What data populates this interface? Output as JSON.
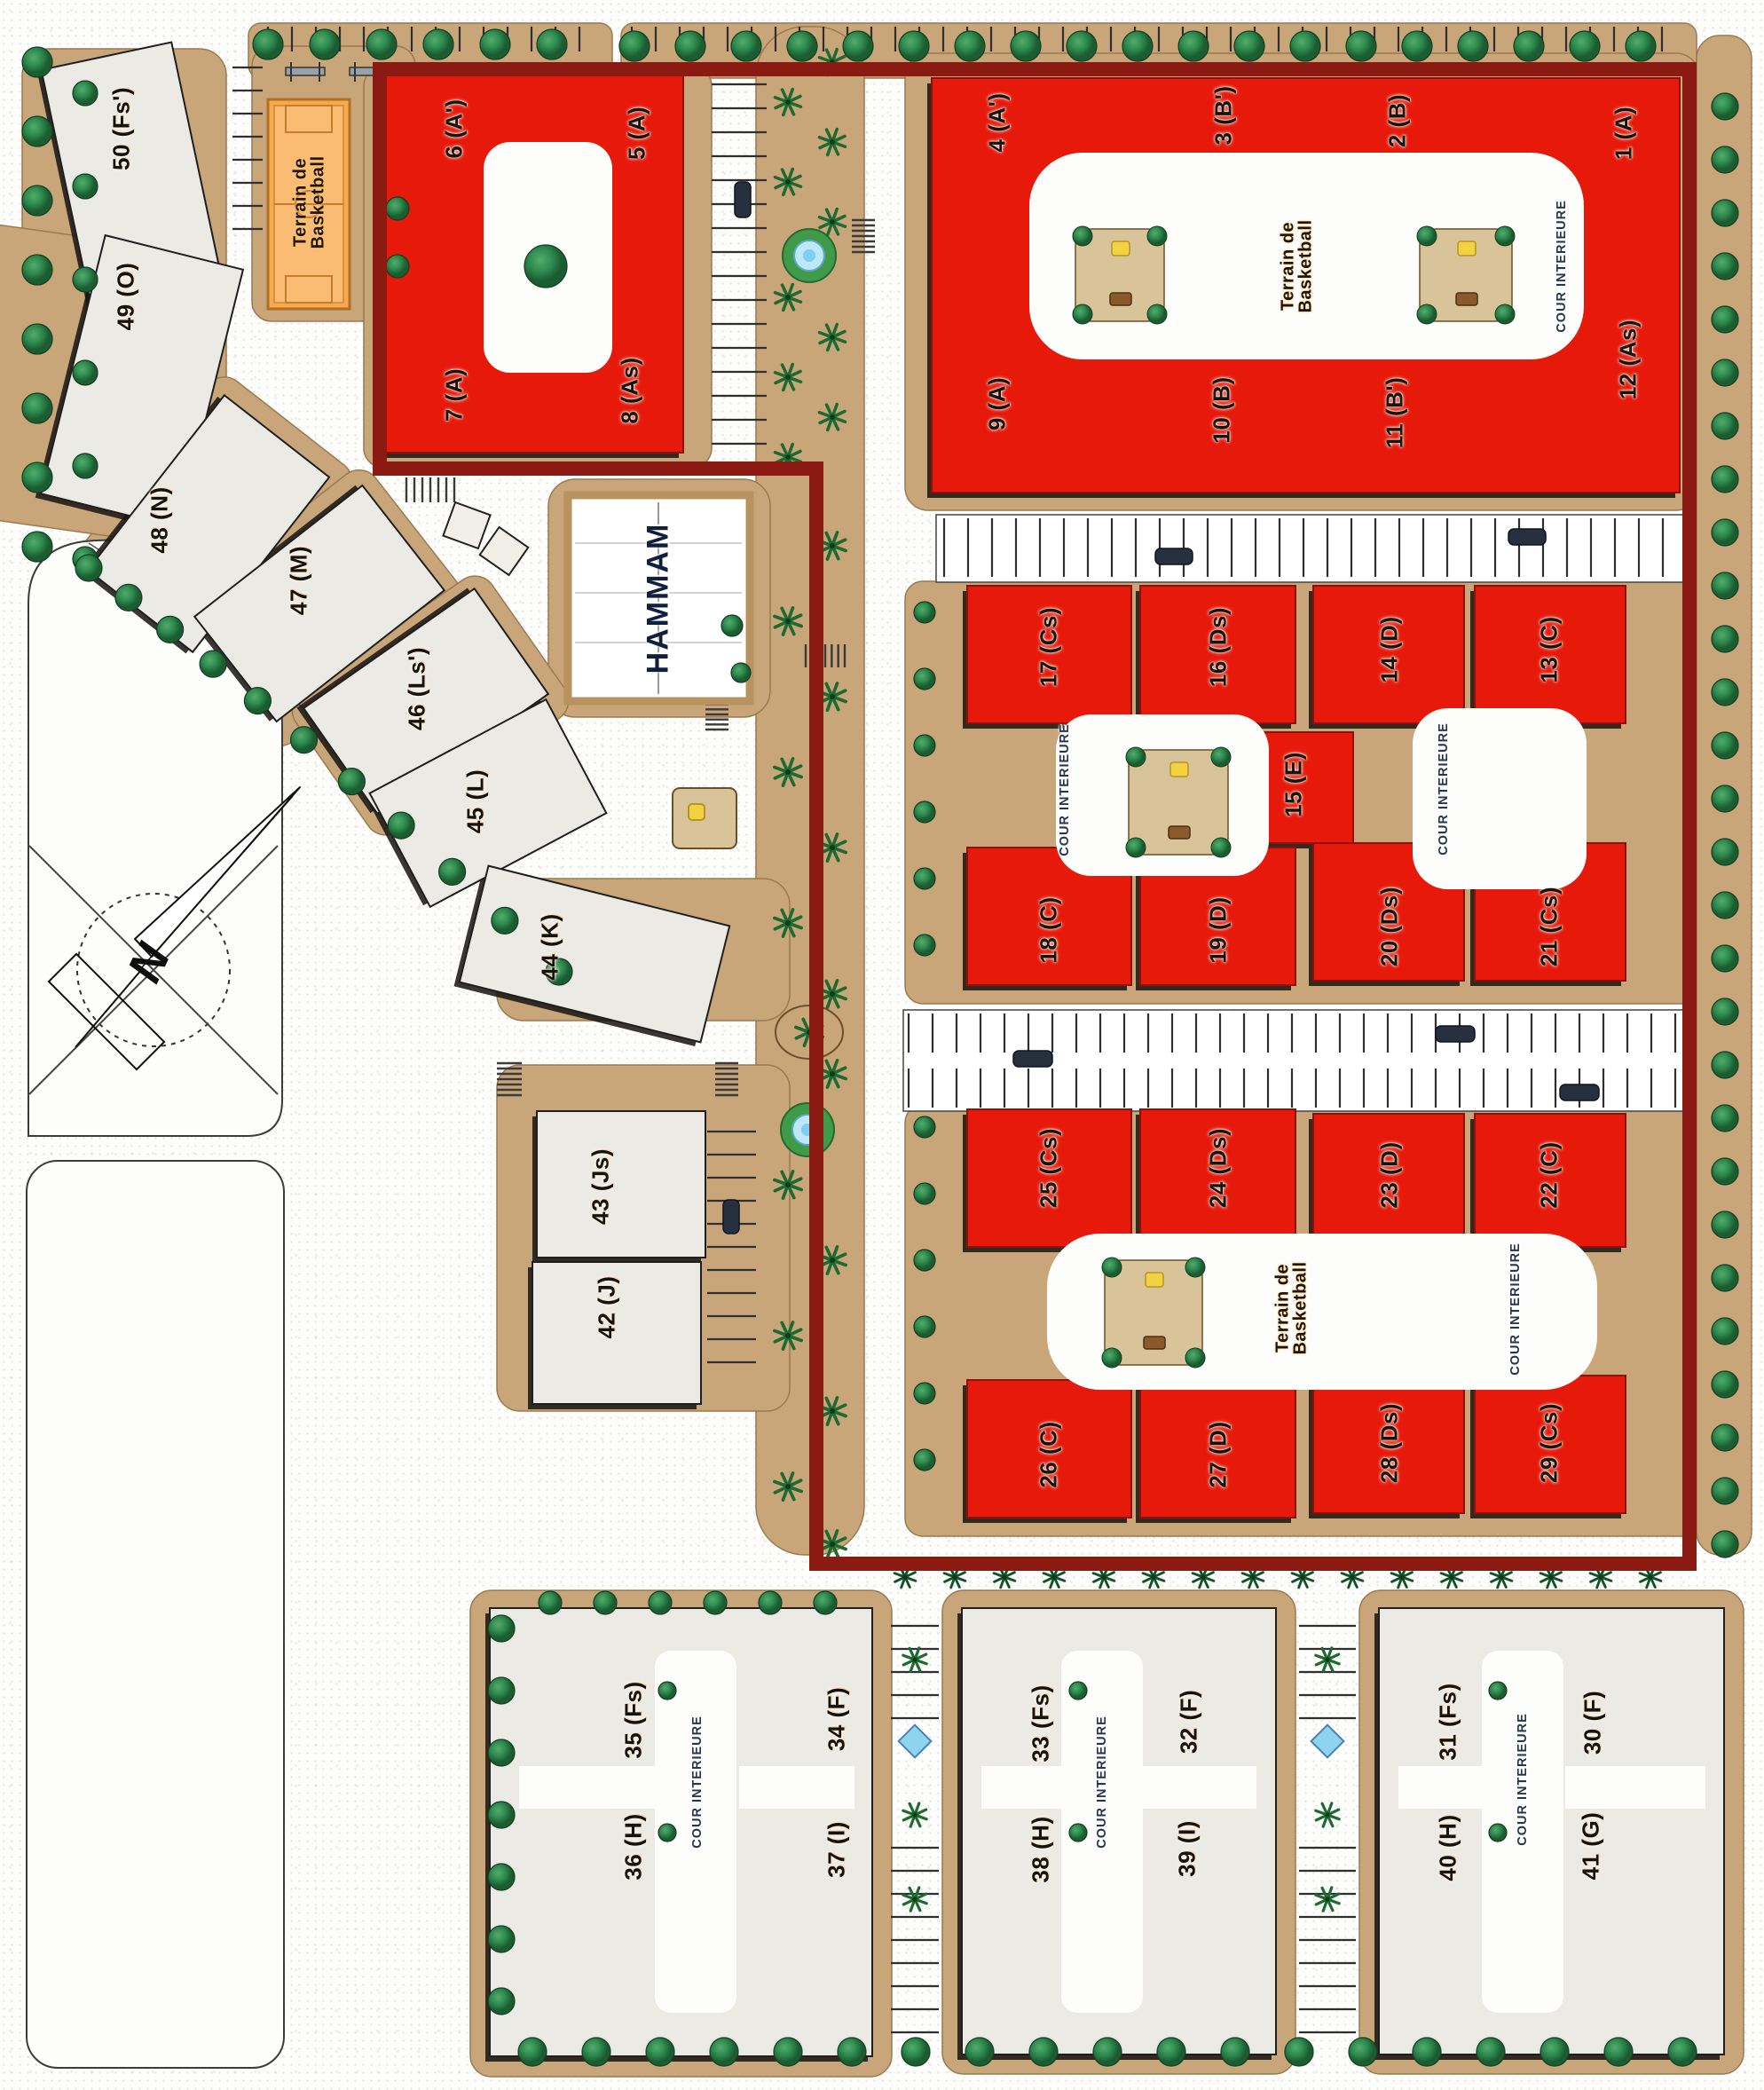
{
  "plan": {
    "type": "residential-master-plan",
    "colors": {
      "highlight_building": "#e6190b",
      "standard_building": "#eae7e2",
      "boundary": "#8a1a12",
      "court": "#f6a94f",
      "ground_pad": "#c9a57a",
      "tree": "#2e8b4f"
    }
  },
  "facilities": {
    "basketball_court_label": "Terrain de\nBasketball",
    "hammam_label": "HAMMAM",
    "inner_courtyard_label": "COUR INTERIEURE"
  },
  "compass": {
    "north_label": "N"
  },
  "buildings": {
    "b1": {
      "label": "1 (A)"
    },
    "b2": {
      "label": "2 (B)"
    },
    "b3": {
      "label": "3 (B')"
    },
    "b4": {
      "label": "4 (A')"
    },
    "b5": {
      "label": "5 (A)"
    },
    "b6": {
      "label": "6 (A')"
    },
    "b7": {
      "label": "7 (A)"
    },
    "b8": {
      "label": "8 (As)"
    },
    "b9": {
      "label": "9 (A)"
    },
    "b10": {
      "label": "10 (B)"
    },
    "b11": {
      "label": "11 (B')"
    },
    "b12": {
      "label": "12 (As)"
    },
    "b13": {
      "label": "13 (C)"
    },
    "b14": {
      "label": "14 (D)"
    },
    "b15": {
      "label": "15 (E)"
    },
    "b16": {
      "label": "16 (Ds)"
    },
    "b17": {
      "label": "17 (Cs)"
    },
    "b18": {
      "label": "18 (C)"
    },
    "b19": {
      "label": "19 (D)"
    },
    "b20": {
      "label": "20 (Ds)"
    },
    "b21": {
      "label": "21 (Cs)"
    },
    "b22": {
      "label": "22 (C)"
    },
    "b23": {
      "label": "23 (D)"
    },
    "b24": {
      "label": "24 (Ds)"
    },
    "b25": {
      "label": "25 (Cs)"
    },
    "b26": {
      "label": "26 (C)"
    },
    "b27": {
      "label": "27 (D)"
    },
    "b28": {
      "label": "28 (Ds)"
    },
    "b29": {
      "label": "29 (Cs)"
    },
    "b30": {
      "label": "30 (F)"
    },
    "b31": {
      "label": "31 (Fs)"
    },
    "b32": {
      "label": "32 (F)"
    },
    "b33": {
      "label": "33 (Fs)"
    },
    "b34": {
      "label": "34 (F)"
    },
    "b35": {
      "label": "35 (Fs)"
    },
    "b36": {
      "label": "36 (H)"
    },
    "b37": {
      "label": "37 (I)"
    },
    "b38": {
      "label": "38 (H)"
    },
    "b39": {
      "label": "39 (I)"
    },
    "b40": {
      "label": "40 (H)"
    },
    "b41": {
      "label": "41 (G)"
    },
    "b42": {
      "label": "42 (J)"
    },
    "b43": {
      "label": "43 (Js)"
    },
    "b44": {
      "label": "44 (K)"
    },
    "b45": {
      "label": "45 (L)"
    },
    "b46": {
      "label": "46 (Ls')"
    },
    "b47": {
      "label": "47 (M)"
    },
    "b48": {
      "label": "48 (N)"
    },
    "b49": {
      "label": "49 (O)"
    },
    "b50": {
      "label": "50 (Fs')"
    }
  }
}
